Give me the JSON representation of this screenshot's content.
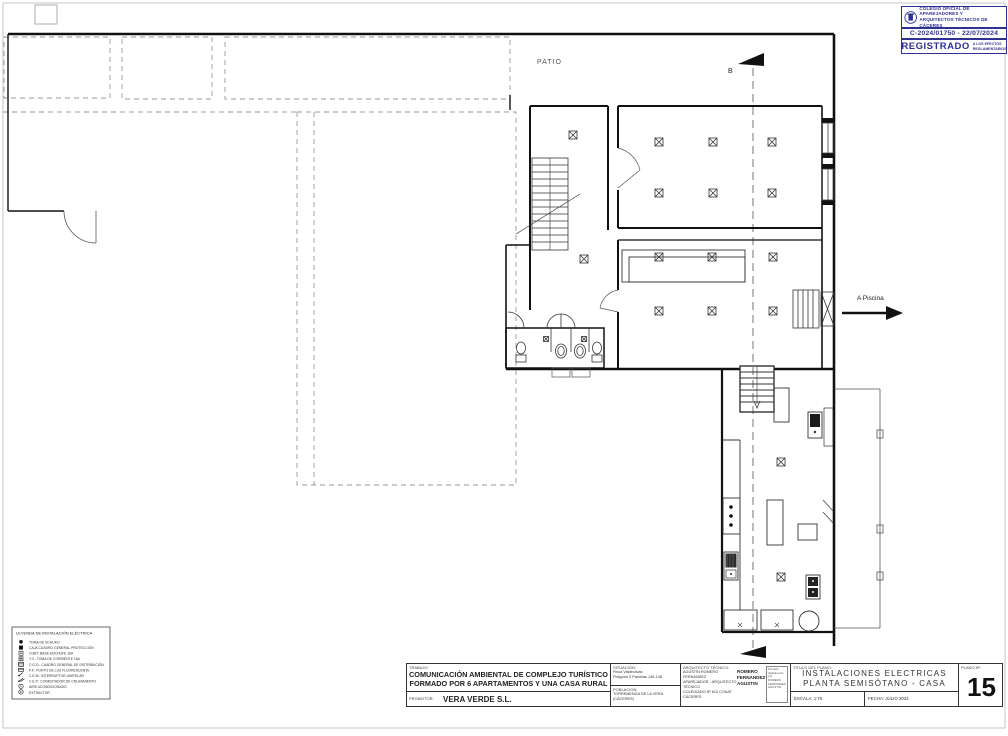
{
  "colors": {
    "stamp_blue": "#2e3192",
    "line_black": "#111111",
    "dashed_gray": "#9a9a9a"
  },
  "stamp": {
    "org_line1": "COLEGIO OFICIAL DE APAREJADORES Y",
    "org_line2": "ARQUITECTOS TÉCNICOS DE CÁCERES",
    "registry": "C-2024/01750 - 22/07/2024",
    "registered": "REGISTRADO",
    "note_line1": "A LOS EFECTOS",
    "note_line2": "REGLAMENTARIOS"
  },
  "plan": {
    "patio": "PATIO",
    "a_piscina": "A Piscina",
    "section_top": "B",
    "section_bottom": "B"
  },
  "legend": {
    "title": "LEYENDA DE INSTALACIÓN ELÉCTRICA",
    "items": [
      {
        "symbol": "filled-circle",
        "label": "TOMA DE SCHUKO"
      },
      {
        "symbol": "filled-square",
        "label": "CAJA CUADRO GENERAL PROTECCIÓN"
      },
      {
        "symbol": "open-square",
        "label": "CGBT: BASE ENCHUFE 16A"
      },
      {
        "symbol": "cross-square",
        "label": "T.C.: TOMA DE CORRIENTE 16A"
      },
      {
        "symbol": "grid-square",
        "label": "C.G.D.: CUADRO GENERAL DE DISTRIBUCIÓN"
      },
      {
        "symbol": "bar-square",
        "label": "P.F.: PUNTO DE LUZ FLUORESCENTE"
      },
      {
        "symbol": "switch",
        "label": "C.E.M.: INTERRUPTOR UNIPOLAR"
      },
      {
        "symbol": "switch-double",
        "label": "C.E.P.: CONMUTADOR DE CRUZAMIENTO"
      },
      {
        "symbol": "circle-A",
        "label": "AIRE ACONDICIONADO"
      },
      {
        "symbol": "circle-E",
        "label": "EXTRACTOR"
      }
    ]
  },
  "title_block": {
    "trabajo_label": "TRABAJO:",
    "trabajo_line1": "COMUNICACIÓN AMBIENTAL DE COMPLEJO TURÍSTICO",
    "trabajo_line2": "FORMADO POR 6 APARTAMENTOS Y UNA CASA RURAL",
    "promotor_label": "PROMOTOR:",
    "promotor_value": "VERA VERDE S.L.",
    "situacion_label": "SITUACIÓN:",
    "situacion_line1": "Finca Valdeolivas",
    "situacion_line2": "Polígono 3 Parcelas 146-148",
    "poblacion_label": "POBLACIÓN:",
    "poblacion_value": "TORREMENGA DE LA VERA (CÁCERES)",
    "arquitecto_label": "ARQUITECTO TÉCNICO:",
    "arquitecto_line1": "AGUSTÍN ROMERO FERNÁNDEZ",
    "arquitecto_line2": "APAREJADOR - ARQUITECTO TÉCNICO",
    "arquitecto_line3": "COLEGIADO Nº 612 COAAT CÁCERES",
    "firma_line1": "ROMERO",
    "firma_line2": "FERNANDEZ",
    "firma_line3": "AGUSTIN",
    "sig_line1": "Firmado",
    "sig_line2": "digitalmente por",
    "sig_line3": "ROMERO FERNANDEZ",
    "sig_line4": "AGUSTIN",
    "titulo_label": "TITULO DEL PLANO:",
    "titulo_line1": "INSTALACIONES ELECTRICAS",
    "titulo_line2": "PLANTA SEMISÓTANO - CASA RURAL",
    "escala_label": "ESCALA:  1:75",
    "fecha_label": "FECHA:  JULIO 2024",
    "plano_label": "PLANO Nº:",
    "plano_value": "15"
  }
}
